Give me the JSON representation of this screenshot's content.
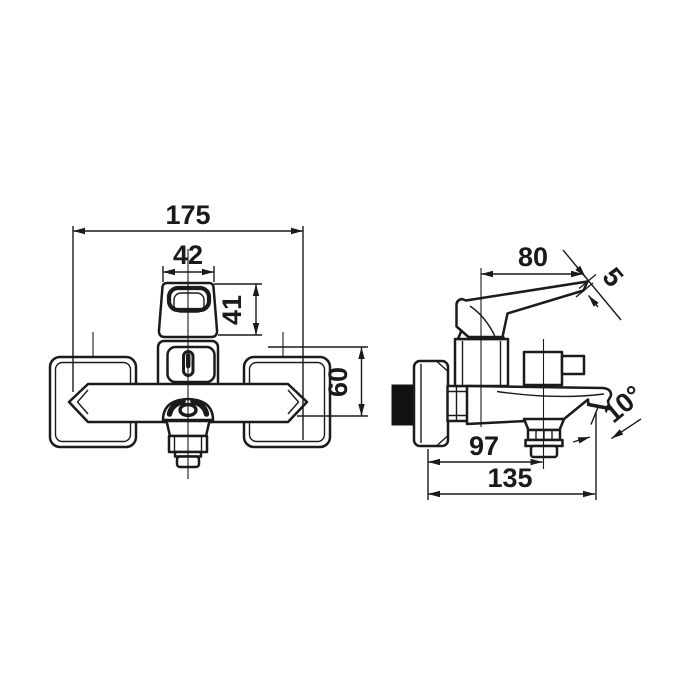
{
  "colors": {
    "line": "#1b1b1b",
    "background": "#ffffff"
  },
  "front_view": {
    "dims": {
      "overall_width": "175",
      "handle_width": "42",
      "handle_height": "41",
      "body_height": "60"
    }
  },
  "side_view": {
    "dims": {
      "lever_length": "80",
      "lever_tip_thickness": "5",
      "wall_to_aerator": "97",
      "wall_to_spout_tip": "135",
      "spout_angle": "10°"
    }
  }
}
